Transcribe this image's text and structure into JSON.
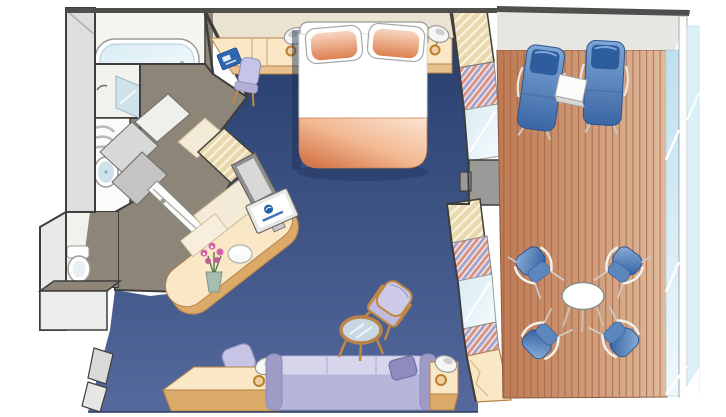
{
  "image": {
    "kind": "cruise-ship-stateroom-floor-plan",
    "style": "isometric-color-illustration",
    "width_px": 726,
    "height_px": 417,
    "visible_text": ""
  },
  "scene": {
    "rooms": [
      {
        "name": "bathroom",
        "fixtures": [
          "bathtub",
          "shower-stall",
          "washbasin-vanity",
          "towel-shelf",
          "toilet"
        ]
      },
      {
        "name": "entry-hall",
        "fixtures": [
          "entry-door",
          "wardrobe-closet"
        ]
      },
      {
        "name": "bedroom-sitting-area",
        "floor": "navy-carpet",
        "fixtures": [
          "queen-bed",
          "pillows",
          "headboard",
          "bedside-counter-desk",
          "desk-chair",
          "information-folder",
          "bedside-lamp-left",
          "nightstand-right",
          "bedside-lamp-right",
          "vanity-desk",
          "vanity-mirror",
          "flat-screen-tv",
          "vanity-stool",
          "flower-vase",
          "sofa",
          "sofa-throw-pillow",
          "end-table-with-lamp",
          "bench-with-lamp",
          "armchair",
          "round-coffee-table",
          "sliding-glass-doors",
          "curtains"
        ]
      },
      {
        "name": "balcony",
        "floor": "teak-deck-planks",
        "fixtures": [
          "lounge-chair-left",
          "lounge-chair-right",
          "drinks-table",
          "round-patio-table",
          "patio-chair-top-left",
          "patio-chair-top-right",
          "patio-chair-bottom-left",
          "patio-chair-bottom-right",
          "glass-railing",
          "deck-overhang"
        ]
      }
    ]
  },
  "palette": {
    "page-bg": "#ffffff",
    "outline": "#3e3e3c",
    "wall-light": "#e9e9e7",
    "wall-mid": "#cfcfcd",
    "wall-top-dark": "#4f4f4d",
    "bath-floor": "#8d8578",
    "cream-wall": "#ebe3d1",
    "furn-top": "#f9e7c6",
    "furn-side": "#e0b27c",
    "furn-edge": "#b5824a",
    "carpet-dark": "#283f6e",
    "carpet-light": "#55699c",
    "peach-dark": "#cf6b3c",
    "peach-light": "#fbdfc9",
    "sofa-main": "#b7b5da",
    "sofa-light": "#d6d5eb",
    "sofa-dark": "#9e9bc7",
    "deck-dark": "#bd7952",
    "deck-light": "#e0bb9e",
    "plank-line": "#a4603e",
    "chair-blue-dark": "#2e5d9e",
    "chair-blue-light": "#8fb2da",
    "glass-blue": "#d8ecf4",
    "curtain-pink": "#dc9184",
    "curtain-lav": "#a7a3d0",
    "hatch-beige": "#e9d8ac",
    "hatch-line": "#faf3e0",
    "wood": "#c08840",
    "tv-blue": "#1f5fae",
    "flower-pink": "#d664a8",
    "leaf-green": "#4e7d4e",
    "metal-gray": "#9a9a98",
    "lamp-gold": "#bc7f2e",
    "white": "#ffffff"
  }
}
